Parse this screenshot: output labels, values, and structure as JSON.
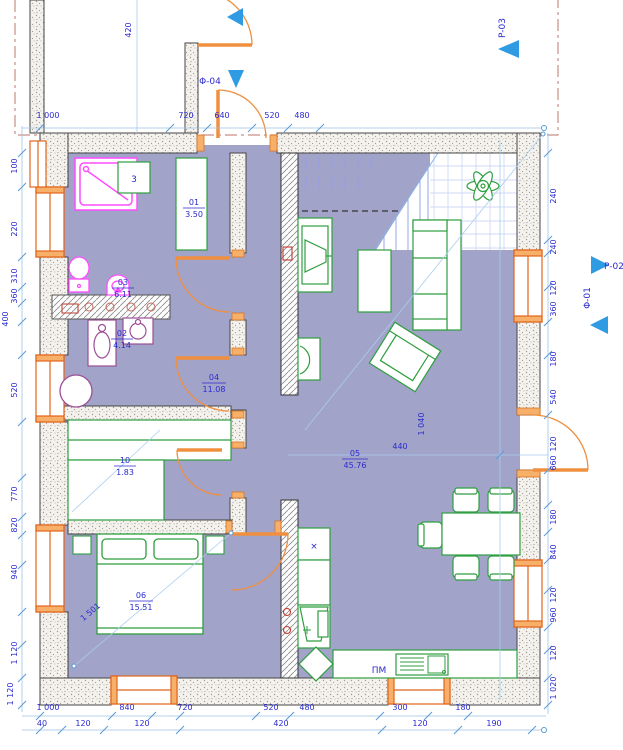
{
  "plan": {
    "type": "architectural-floor-plan",
    "colors": {
      "floor": "#a2a3c9",
      "furniture_green": "#2f9e3f",
      "sanitary_magenta": "#ff4dff",
      "fixture_purple": "#9b4f96",
      "openings_orange": "#ef8f3f",
      "dimension_blue": "#2a2ad0",
      "marker_blue": "#2e9be2",
      "section_line": "#c98e83"
    },
    "rooms": {
      "closet": {
        "num": "01",
        "area": "3.50"
      },
      "wc": {
        "num": "02",
        "area": "4.14"
      },
      "bathroom": {
        "num": "03",
        "area": "6.11"
      },
      "hallway": {
        "num": "04",
        "area": "11.08"
      },
      "living": {
        "num": "05",
        "area": "45.76"
      },
      "bedroom": {
        "num": "06",
        "area": "15.51"
      },
      "wardrobe": {
        "num": "10",
        "area": "1.83"
      }
    },
    "labels": {
      "box3": "3",
      "dishwasher": "ПМ",
      "cooktop": "×"
    },
    "markers": {
      "p03": "P-03",
      "p02": "P-02",
      "f01": "Φ-01",
      "f04": "Φ-04"
    },
    "dims": {
      "top": [
        "1 000",
        "720",
        "640",
        "520",
        "480"
      ],
      "top_vert": "420",
      "bottom1": [
        "1 000",
        "840",
        "720",
        "520",
        "480",
        "300",
        "180"
      ],
      "bottom2": [
        "40",
        "120",
        "120",
        "420",
        "120",
        "190"
      ],
      "left": [
        "100",
        "220",
        "310",
        "360",
        "400",
        "520",
        "770",
        "820",
        "940",
        "1 120",
        "1 120"
      ],
      "right": [
        "240",
        "240",
        "120",
        "360",
        "180",
        "540",
        "120",
        "660",
        "180",
        "840",
        "120",
        "960",
        "120",
        "1 020"
      ],
      "living_w": "440",
      "living_v": "1 040",
      "bed_diag": "1 501"
    }
  }
}
